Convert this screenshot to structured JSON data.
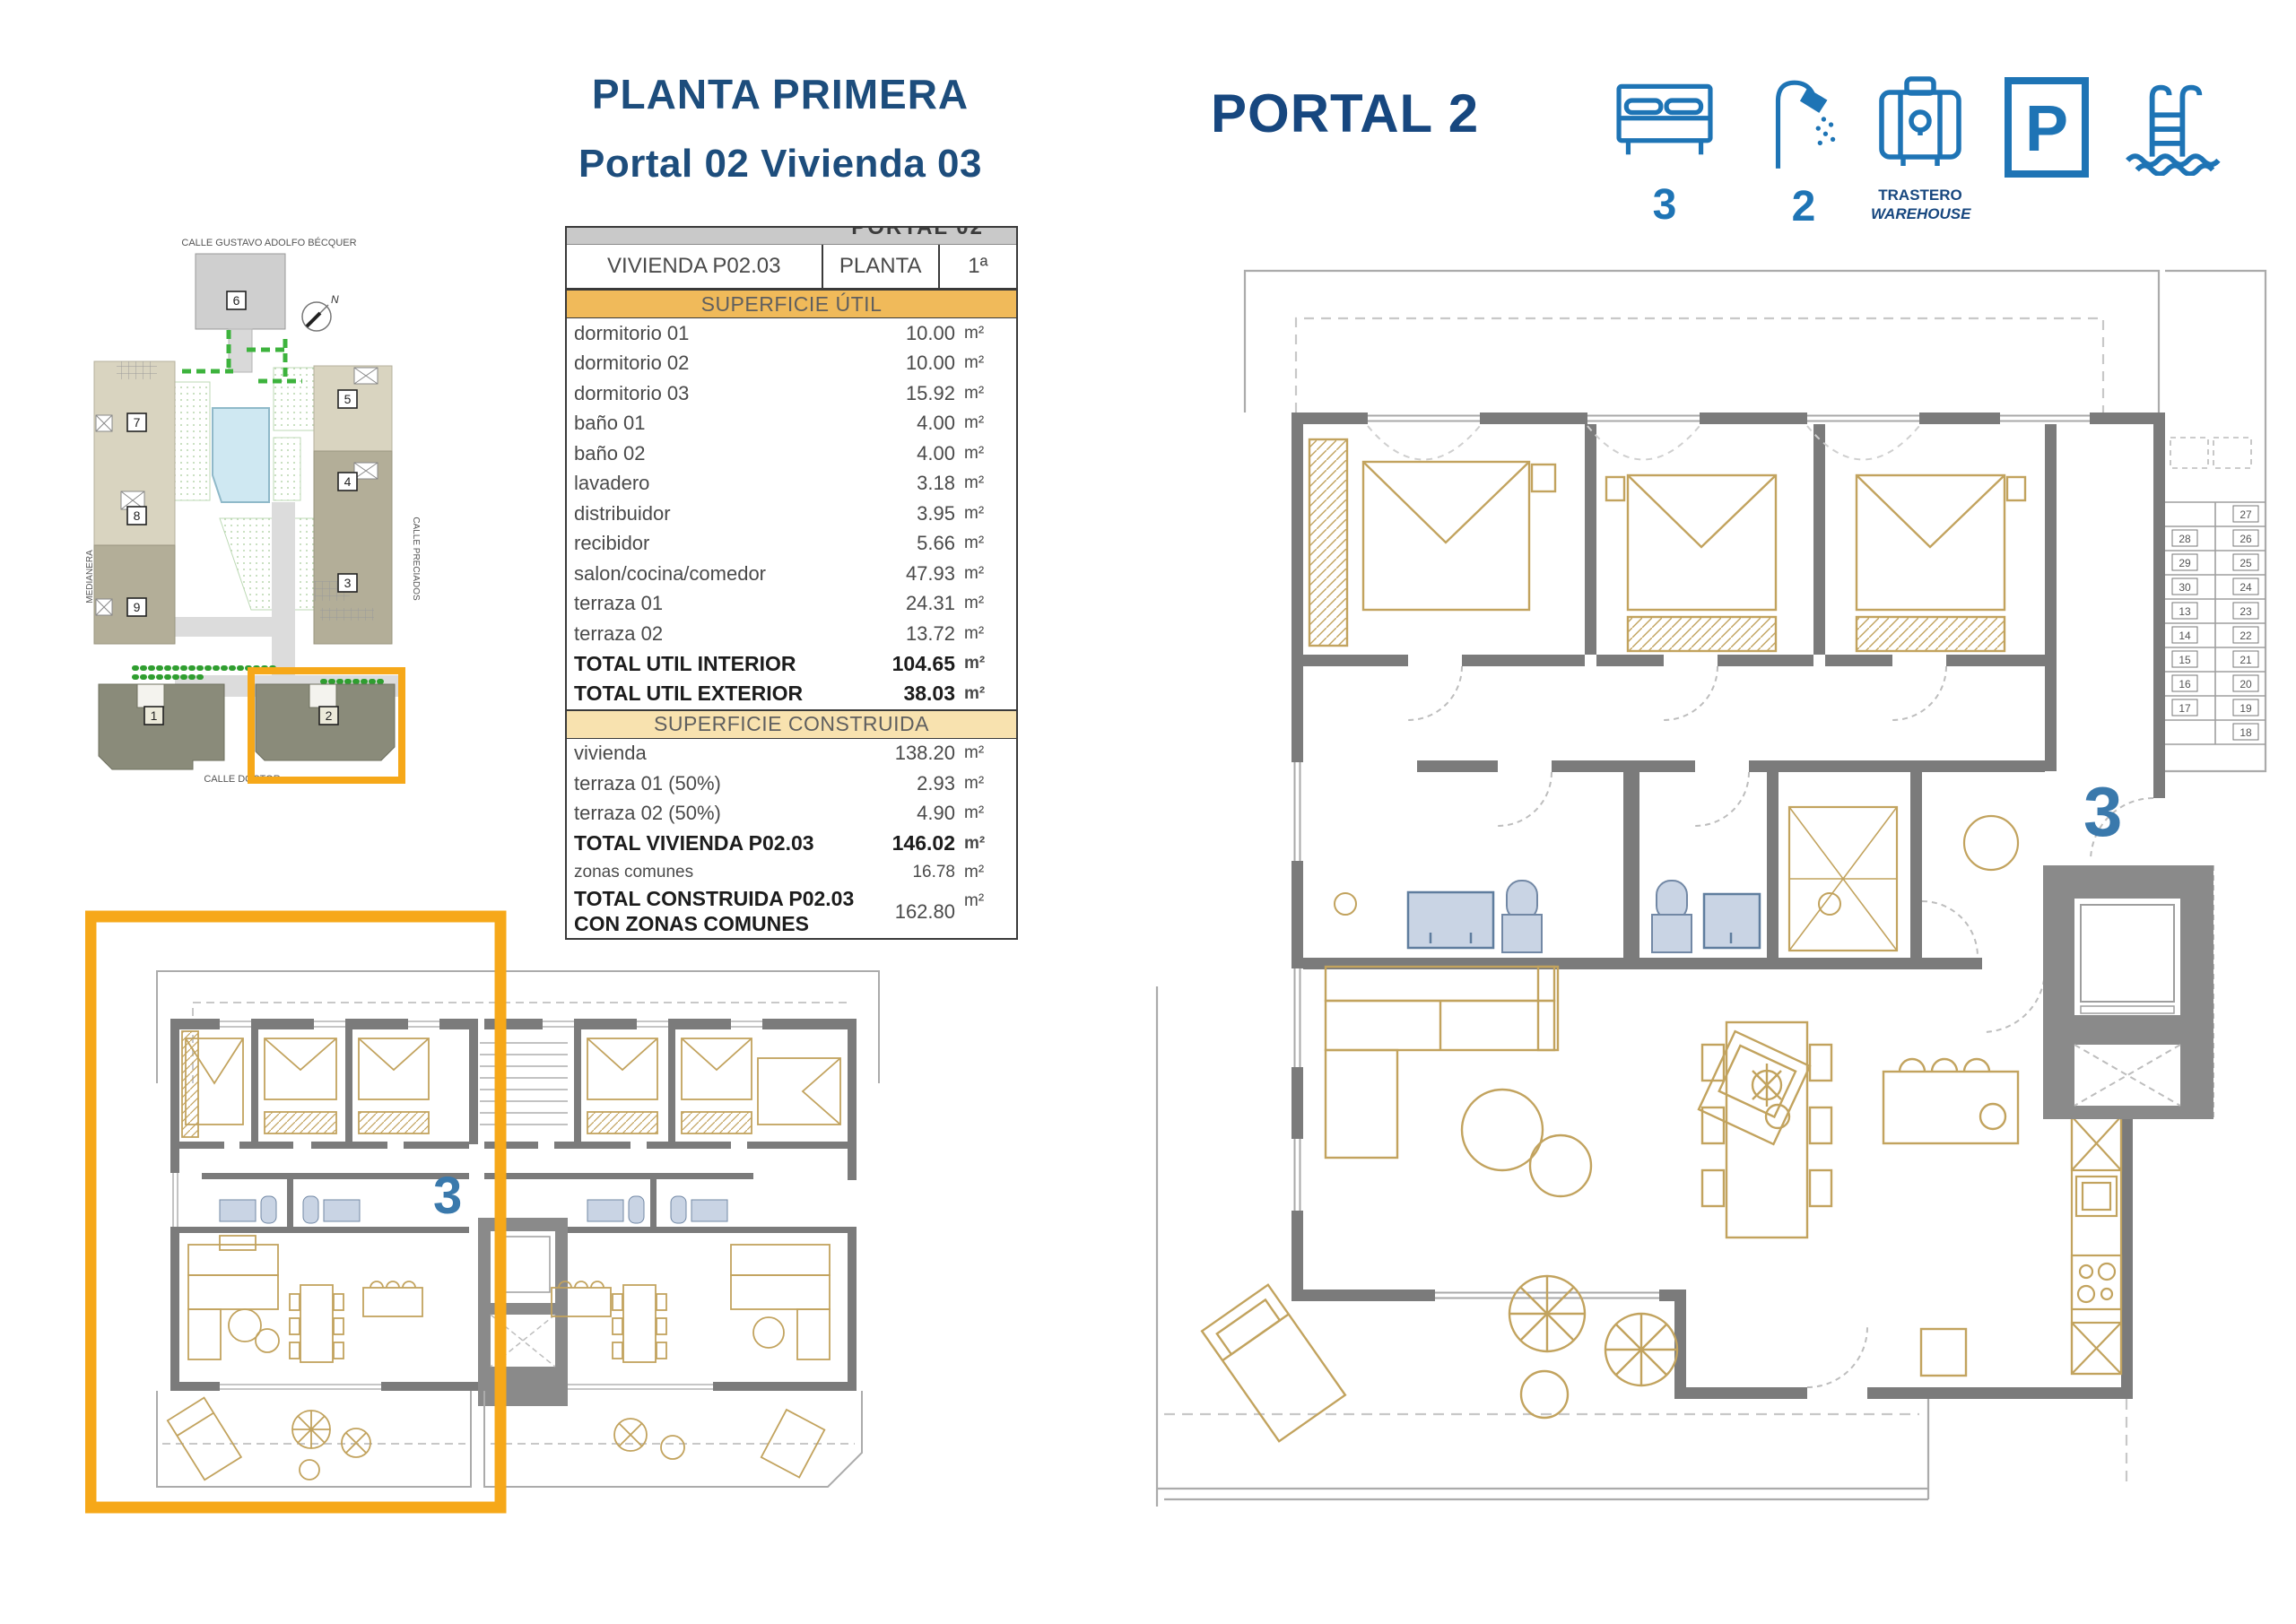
{
  "header": {
    "title": "PLANTA PRIMERA",
    "subtitle": "Portal 02 Vivienda 03",
    "portal": "PORTAL 2"
  },
  "amenities": {
    "bedrooms": "3",
    "bathrooms": "2",
    "trastero_line1": "TRASTERO",
    "trastero_line2": "WAREHOUSE",
    "parking_letter": "P"
  },
  "site_plan": {
    "street_top": "CALLE  GUSTAVO  ADOLFO  BÉCQUER",
    "street_left": "MEDIANERA",
    "street_right": "CALLE  PRECIADOS",
    "street_bottom": "CALLE  DOCTOR",
    "north": "N",
    "buildings": [
      "1",
      "2",
      "3",
      "4",
      "5",
      "6",
      "7",
      "8",
      "9"
    ]
  },
  "table": {
    "top_strip": "PORTAL 02",
    "unit_name": "VIVIENDA P02.03",
    "floor_label": "PLANTA",
    "floor_value": "1ª",
    "section_util": "SUPERFICIE ÚTIL",
    "section_cons": "SUPERFICIE CONSTRUIDA",
    "unit": "m²",
    "rows_util": [
      {
        "label": "dormitorio 01",
        "value": "10.00"
      },
      {
        "label": "dormitorio 02",
        "value": "10.00"
      },
      {
        "label": "dormitorio 03",
        "value": "15.92"
      },
      {
        "label": "baño 01",
        "value": "4.00"
      },
      {
        "label": "baño 02",
        "value": "4.00"
      },
      {
        "label": "lavadero",
        "value": "3.18"
      },
      {
        "label": "distribuidor",
        "value": "3.95"
      },
      {
        "label": "recibidor",
        "value": "5.66"
      },
      {
        "label": "salon/cocina/comedor",
        "value": "47.93"
      },
      {
        "label": "terraza 01",
        "value": "24.31"
      },
      {
        "label": "terraza 02",
        "value": "13.72"
      },
      {
        "label": "TOTAL UTIL INTERIOR",
        "value": "104.65"
      },
      {
        "label": "TOTAL UTIL EXTERIOR",
        "value": "38.03"
      }
    ],
    "rows_cons": [
      {
        "label": "vivienda",
        "value": "138.20"
      },
      {
        "label": "terraza 01 (50%)",
        "value": "2.93"
      },
      {
        "label": "terraza 02 (50%)",
        "value": "4.90"
      },
      {
        "label": "TOTAL VIVIENDA P02.03",
        "value": "146.02"
      },
      {
        "label": "zonas comunes",
        "value": "16.78"
      },
      {
        "label_line1": "TOTAL CONSTRUIDA P02.03",
        "label_line2": "CON ZONAS COMUNES",
        "value": "162.80"
      }
    ]
  },
  "plans": {
    "unit_label_left": "3",
    "unit_label_right": "3",
    "stairs_left": [
      "28",
      "29",
      "30",
      "13",
      "14",
      "15",
      "16",
      "17"
    ],
    "stairs_right": [
      "27",
      "26",
      "25",
      "24",
      "23",
      "22",
      "21",
      "20",
      "19",
      "18"
    ]
  },
  "colors": {
    "navy": "#1d4d7c",
    "icon_blue": "#1e74b5",
    "plan_blue": "#3a79ac",
    "highlight_orange": "#f6a819",
    "band_orange": "#f0ba5a",
    "band_cream": "#f8e2af",
    "wall_gray": "#7b7b7b",
    "furniture_tan": "#c2a35e",
    "fixture_blue": "#c9d4e4"
  }
}
